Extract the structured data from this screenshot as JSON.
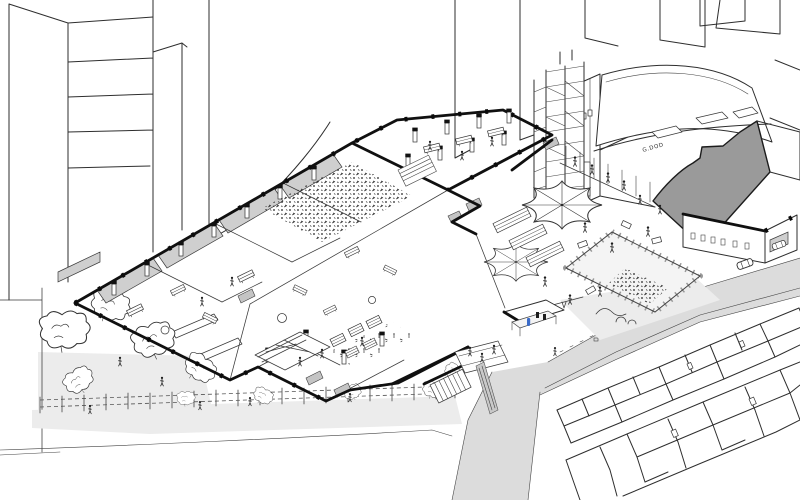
{
  "scene": {
    "kind": "hand-drawn axonometric cutaway illustration",
    "description": "Cutaway aerial line drawing of an urban cultural venue block: open-roof halls with columns and crowds, workshop rooms, a courtyard with star tents and a fenced play area, a garden with trees along a fenced walk, a large curved-roof venue with a grey cut wall, a scaffold tower, surrounding streets with cars and terraced rooftops",
    "fascia_sign": "G.DOD"
  },
  "palette": {
    "paper": "#ffffff",
    "ink": "#2e2e2e",
    "cut_wall_black": "#101010",
    "section_gray": "#9a9a9a",
    "roof_panel_gray": "#cfcfcf",
    "ground_wash_gray": "#ececec",
    "street_gray": "#dcdcdc",
    "accent_blue": "#3a6bc9"
  },
  "features": {
    "tents": 2,
    "cars": 2,
    "garden_trees": 5,
    "fence_plants": 5,
    "crowd_areas": 3,
    "scaffold_levels": 8,
    "picnic_tables": 3,
    "roof_rows": 2
  },
  "named_areas": [
    "background city blocks",
    "curved-roof venue hall",
    "scaffold tower",
    "annex building",
    "open-plan hall with columns",
    "performance crowd",
    "workshop rooms",
    "cafe terrace",
    "courtyard with star tents",
    "fenced play area",
    "kiosk with blue figure",
    "entrance bridge and stairs",
    "garden with trees",
    "fenced canal-side walk",
    "main street with cars",
    "side street",
    "terraced rooftops"
  ]
}
